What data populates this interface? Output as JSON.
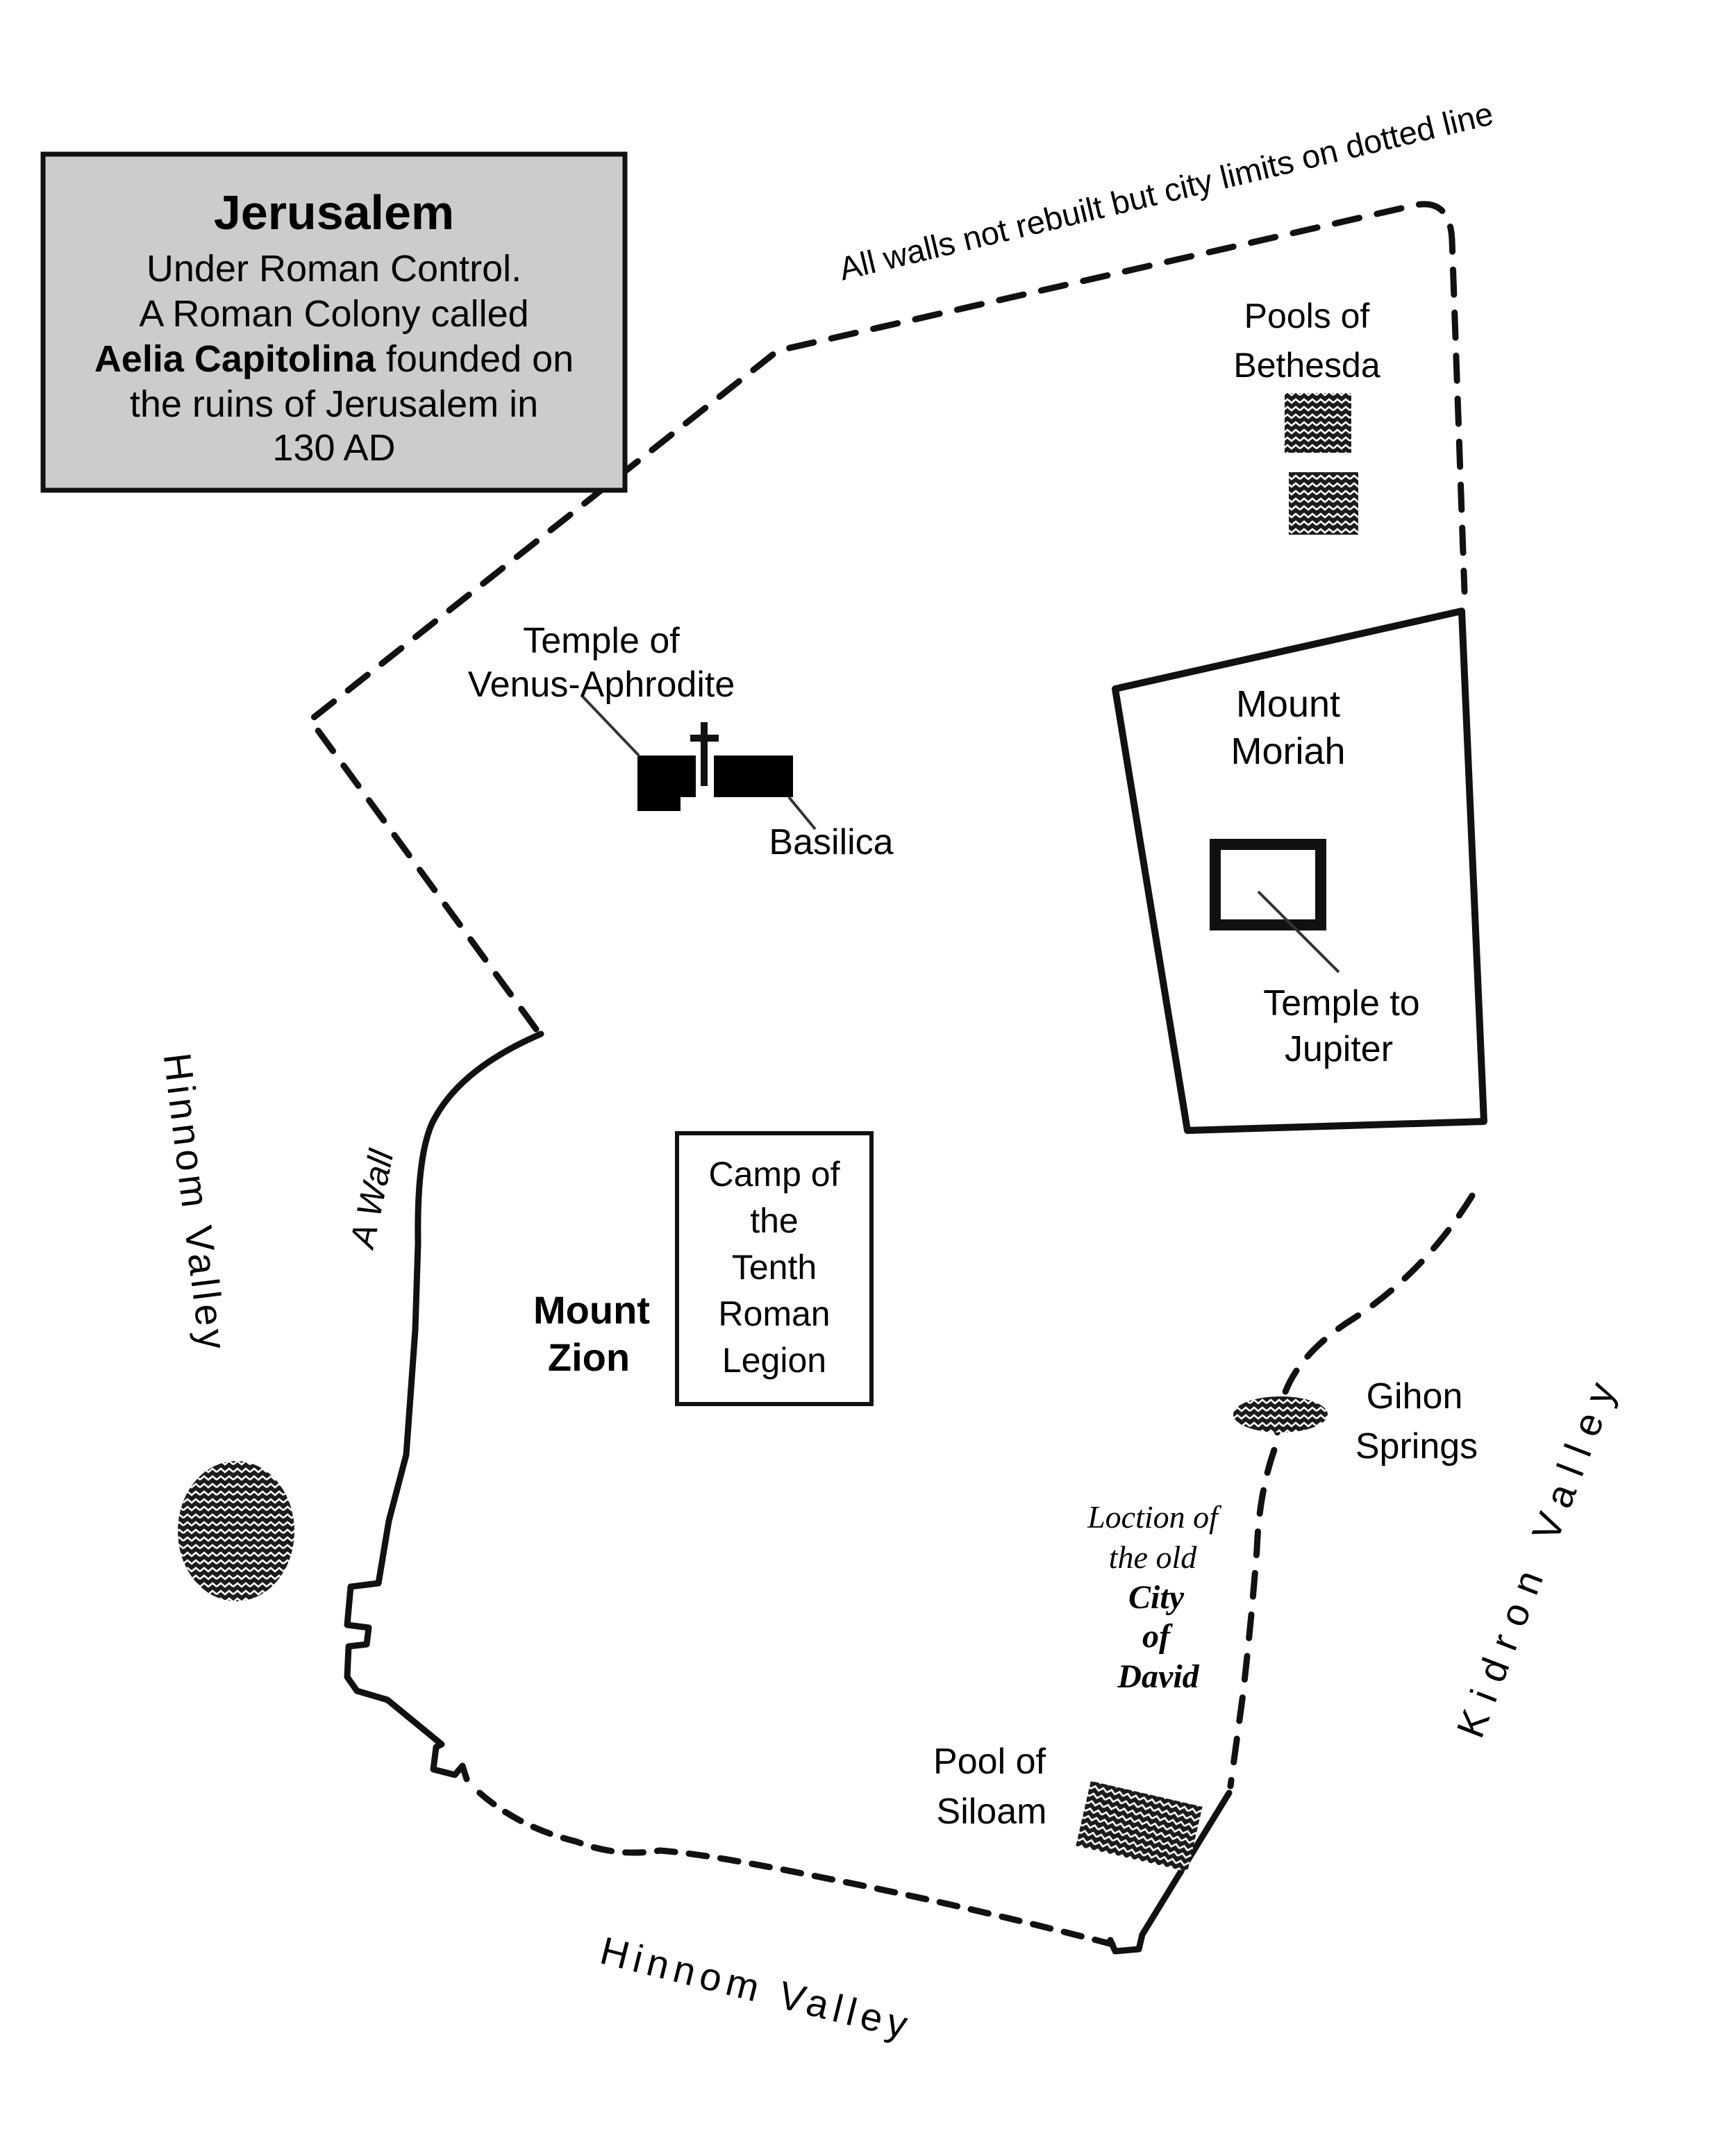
{
  "title_box": {
    "title": "Jerusalem",
    "line1": "Under Roman Control.",
    "line2": "A Roman Colony called",
    "line3_bold": "Aelia Capitolina",
    "line3_rest": " founded on",
    "line4": "the ruins of Jerusalem in",
    "line5": "130 AD"
  },
  "annotations": {
    "city_limits_note": "All walls not rebuilt but city limits on dotted line",
    "a_wall": "A Wall"
  },
  "places": {
    "pools_bethesda": {
      "line1": "Pools of",
      "line2": "Bethesda"
    },
    "temple_venus": {
      "line1": "Temple of",
      "line2": "Venus-Aphrodite"
    },
    "basilica": "Basilica",
    "mount_moriah": {
      "line1": "Mount",
      "line2": "Moriah"
    },
    "temple_jupiter": {
      "line1": "Temple to",
      "line2": "Jupiter"
    },
    "camp": {
      "line1": "Camp of",
      "line2": "the",
      "line3": "Tenth",
      "line4": "Roman",
      "line5": "Legion"
    },
    "mount_zion": {
      "line1": "Mount",
      "line2": "Zion"
    },
    "gihon": {
      "line1": "Gihon",
      "line2": "Springs"
    },
    "city_of_david": {
      "line1": "Loction of",
      "line2": "the old",
      "line3": "City",
      "line4": "of",
      "line5": "David"
    },
    "pool_siloam": {
      "line1": "Pool of",
      "line2": "Siloam"
    }
  },
  "valleys": {
    "hinnom_west": "Hinnom Valley",
    "hinnom_south": "Hinnom Valley",
    "kidron": "Kidron Valley"
  },
  "colors": {
    "ink": "#111111",
    "box_fill": "#cccccc",
    "background": "#ffffff"
  }
}
